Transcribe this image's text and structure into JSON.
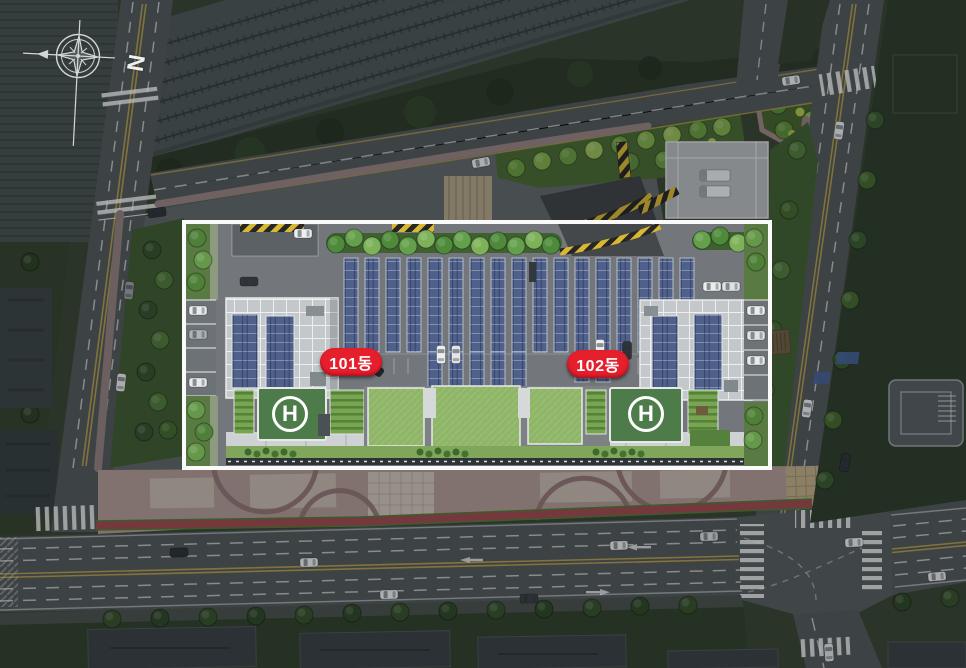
{
  "scene": {
    "description": "apartment complex site plan aerial rendering",
    "background_color": "#3a4433",
    "highlight_border_color": "#ffffff"
  },
  "compass": {
    "north_label": "N"
  },
  "buildings": [
    {
      "id": "101",
      "badge_label": "101동",
      "badge_color": "#e61f2d",
      "text_color": "#ffffff"
    },
    {
      "id": "102",
      "badge_label": "102동",
      "badge_color": "#e61f2d",
      "text_color": "#ffffff"
    }
  ],
  "helipads": [
    {
      "symbol": "H",
      "pad_color": "#4d7c4a"
    },
    {
      "symbol": "H",
      "pad_color": "#4d7c4a"
    }
  ],
  "site_colors": {
    "solar_panel": "#4f618b",
    "tower_roof": "#c4c8cb",
    "lawn": "#8fb567",
    "deck": "#73777b",
    "plaza_pink": "#b09a96",
    "red_strip": "#a04b4f",
    "hazard_yellow": "#d9b832"
  }
}
